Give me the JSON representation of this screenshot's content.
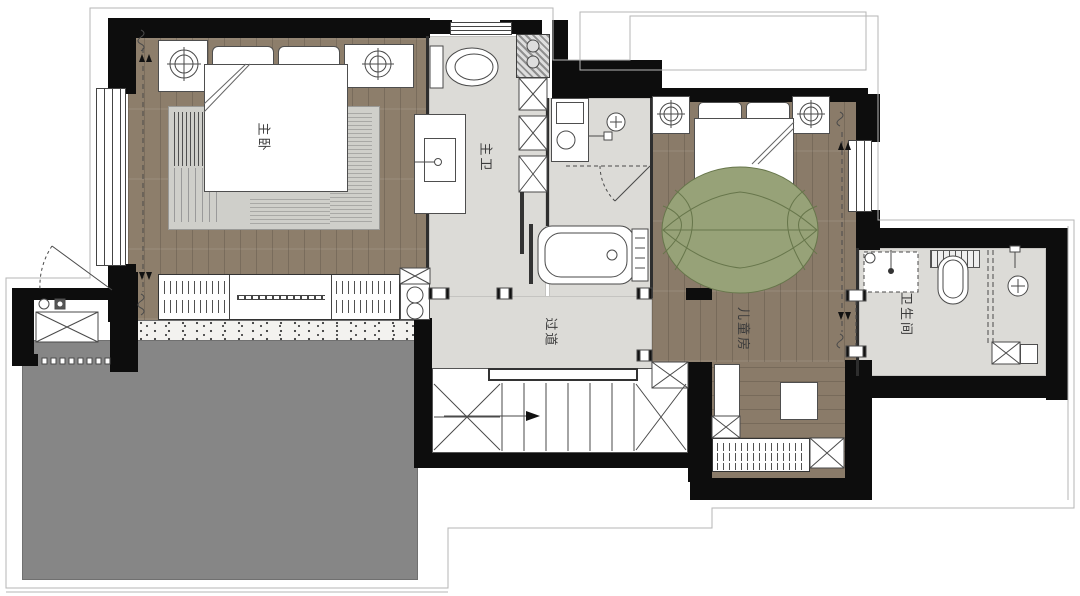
{
  "plan_type": "residential-floor-plan",
  "rooms": {
    "master_bedroom": "主卧",
    "master_bath": "主卫",
    "corridor": "过道",
    "kids_room": "儿童房",
    "bathroom": "卫生间"
  },
  "colors": {
    "wall": "#0d0d0d",
    "wood_master": "#8d7e6b",
    "wood_kids": "#8a7b69",
    "tile": "#dcdbd7",
    "terrace": "#868686",
    "rug_master": "#cfcfca",
    "rug_kids_fill": "#97a278",
    "rug_kids_line": "#67764b",
    "outline": "#b5b5b5",
    "linework": "#4a4a4a"
  }
}
